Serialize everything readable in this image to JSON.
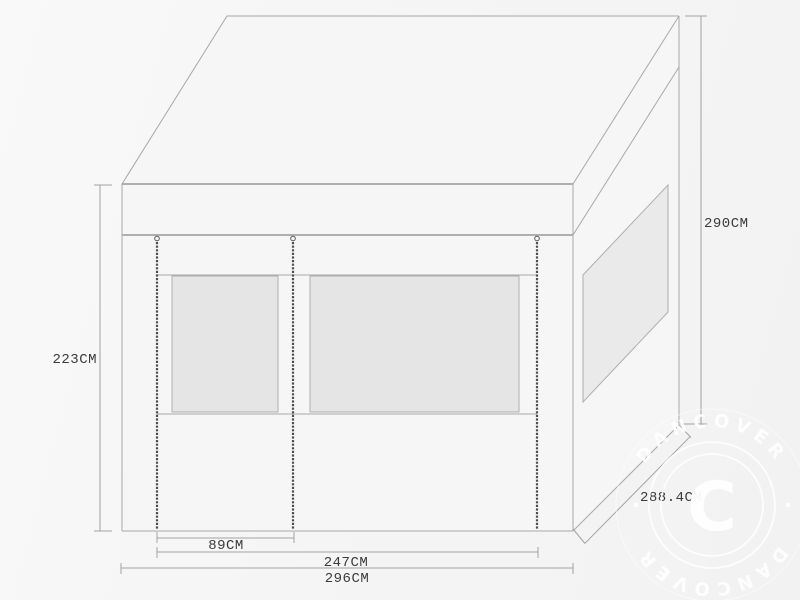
{
  "diagram": {
    "title": "Pavilion / gazebo panel technical drawing",
    "dimensions": {
      "front_height": {
        "label": "223CM",
        "value": 223,
        "unit": "CM"
      },
      "total_height": {
        "label": "290CM",
        "value": 290,
        "unit": "CM"
      },
      "door_width": {
        "label": "89CM",
        "value": 89,
        "unit": "CM"
      },
      "panel_width": {
        "label": "247CM",
        "value": 247,
        "unit": "CM"
      },
      "front_width": {
        "label": "296CM",
        "value": 296,
        "unit": "CM"
      },
      "side_depth": {
        "label": "288.4CM",
        "value": 288.4,
        "unit": "CM"
      }
    },
    "colors": {
      "line": "#a8a8a8",
      "window_fill": "#e5e5e5",
      "zipper": "#4f4f4f",
      "label_text": "#3b3b3b",
      "background": "#f5f5f5",
      "watermark": "#ffffff"
    }
  },
  "watermark": {
    "brand_arc_top": "DANCOVER",
    "brand_arc_bottom": "DANCOVER",
    "center_letter": "C"
  }
}
